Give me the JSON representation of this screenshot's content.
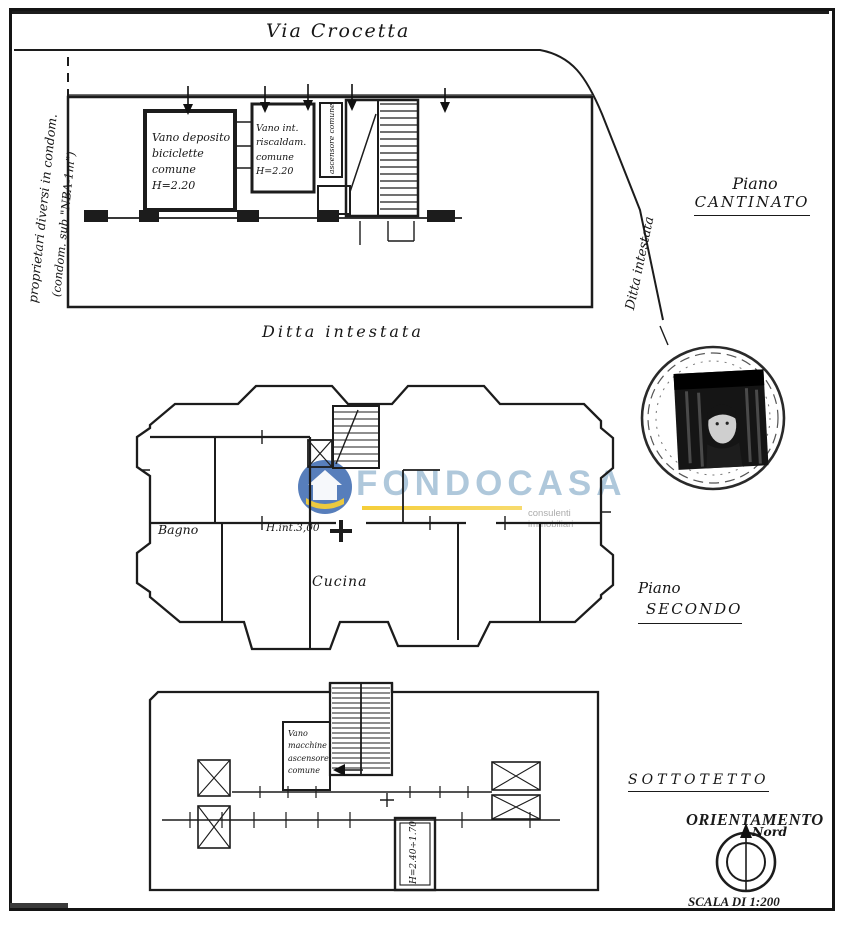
{
  "street": {
    "label": "Via Crocetta"
  },
  "margin_note": {
    "line1": "proprietari diversi in condom.",
    "line2": "(condom. sub \"NBA-1m\")"
  },
  "diagonal_note": {
    "label": "Ditta intestata"
  },
  "cantinato": {
    "title_line1": "Piano",
    "title_line2": "CANTINATO",
    "caption": "Ditta intestata",
    "room_biciclette": "Vano deposito\nbiciclette\ncomune\nH=2.20",
    "room_riscaldamento": "Vano int.\nriscaldam.\ncomune\nH=2.20",
    "room_ascensore": "ascensore comune"
  },
  "secondo": {
    "title_line1": "Piano",
    "title_line2": "SECONDO",
    "room_bagno": "Bagno",
    "corridor_height": "H.int.3,00",
    "room_cucina": "Cucina"
  },
  "sottotetto": {
    "title": "SOTTOTETTO",
    "room_macchine": "Vano\nmacchine\nascensore\ncomune",
    "height_note": "H=2.40÷1.70"
  },
  "watermark": {
    "brand": "FONDOCASA",
    "tagline": "consulenti immobiliari",
    "brand_color": "#8eb2cd",
    "accent_color": "#f4c81e",
    "icon_color": "#2a5ca8"
  },
  "orientation": {
    "title": "ORIENTAMENTO",
    "north": "Nord",
    "scale": "SCALA DI 1:200"
  }
}
